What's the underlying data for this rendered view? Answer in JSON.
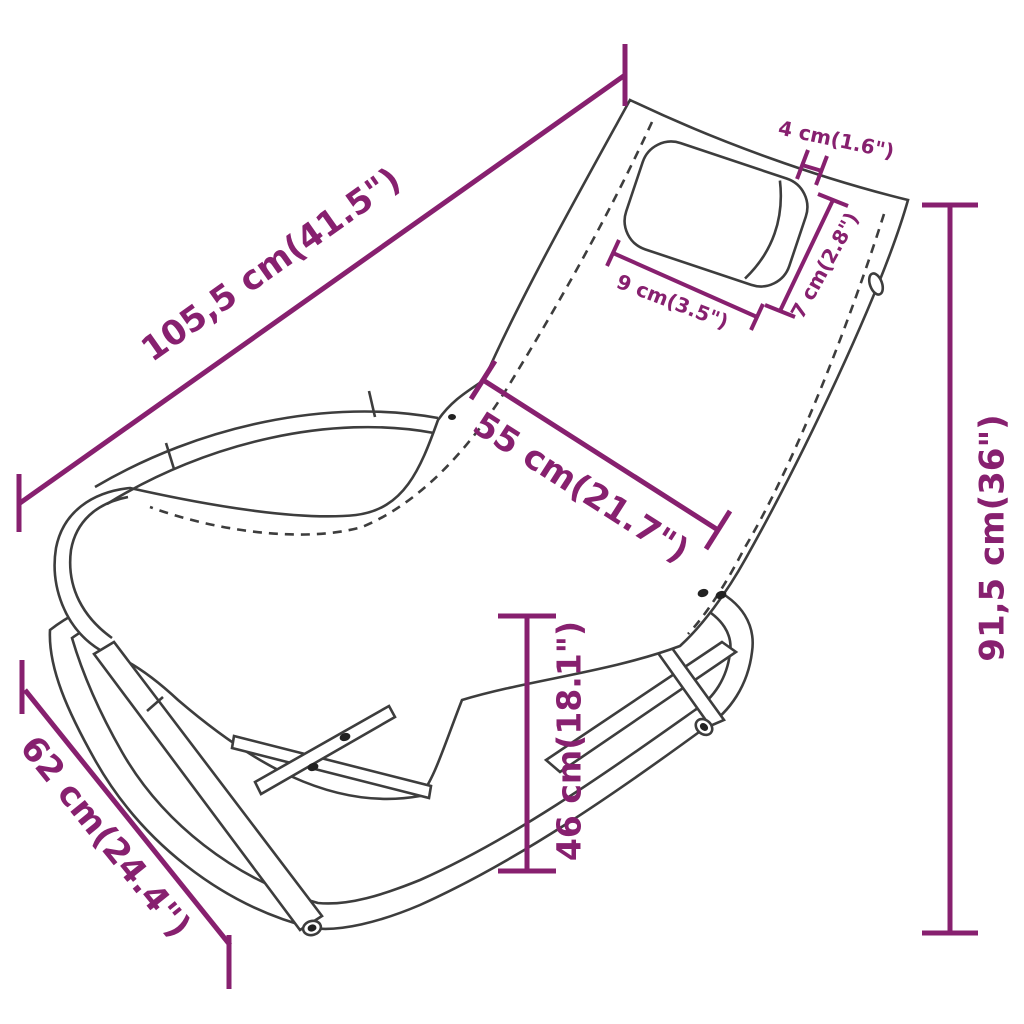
{
  "diagram": {
    "type": "product-dimension-drawing",
    "product": "rocking-sun-lounger-with-pillow",
    "colors": {
      "dimension_color": "#87206F",
      "line_color": "#3D3D3D",
      "background": "#FFFFFF"
    },
    "dims": {
      "total_length": {
        "label": "105,5 cm(41.5\")"
      },
      "seat_depth": {
        "label": "55 cm(21.7\")"
      },
      "total_height": {
        "label": "91,5 cm(36\")"
      },
      "seat_height": {
        "label": "46 cm(18.1\")"
      },
      "base_width": {
        "label": "62 cm(24.4\")"
      },
      "pillow_thickness": {
        "label": "4 cm(1.6\")"
      },
      "pillow_length": {
        "label": "9 cm(3.5\")"
      },
      "pillow_width": {
        "label": "7 cm(2.8\")"
      }
    }
  }
}
